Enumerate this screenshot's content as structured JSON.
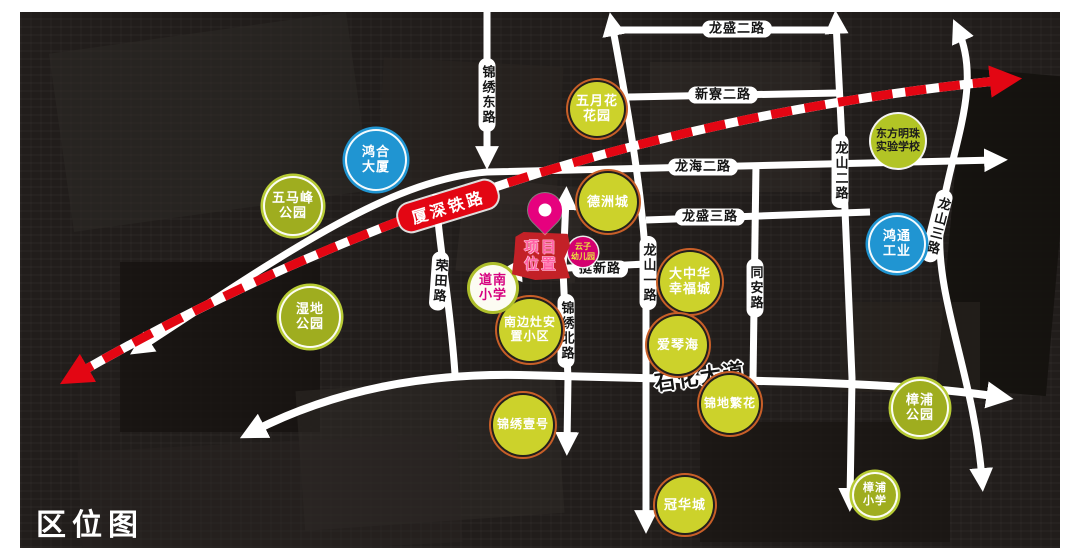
{
  "title": "区位图",
  "railway": {
    "label": "厦深铁路"
  },
  "project": {
    "line1": "项目",
    "line2": "位置"
  },
  "roads": [
    {
      "id": "jinxiu-east",
      "label": "锦绣东路"
    },
    {
      "id": "longsheng-2",
      "label": "龙盛二路"
    },
    {
      "id": "xinliao-2",
      "label": "新寮二路"
    },
    {
      "id": "longhai-2",
      "label": "龙海二路"
    },
    {
      "id": "longsheng-3",
      "label": "龙盛三路"
    },
    {
      "id": "longshan-1",
      "label": "龙山一路"
    },
    {
      "id": "longshan-2",
      "label": "龙山二路"
    },
    {
      "id": "longshan-3",
      "label": "龙山三路"
    },
    {
      "id": "tongan",
      "label": "同安路"
    },
    {
      "id": "rongtian",
      "label": "荣田路"
    },
    {
      "id": "tingxin",
      "label": "挺新路"
    },
    {
      "id": "jinxiu-north",
      "label": "锦绣北路"
    },
    {
      "id": "shihua",
      "label": "石化大道"
    }
  ],
  "landmarks": [
    {
      "id": "wumafeng-park",
      "type": "park",
      "line1": "五马峰",
      "line2": "公园"
    },
    {
      "id": "honghe-tower",
      "type": "blue",
      "line1": "鸿合",
      "line2": "大厦"
    },
    {
      "id": "wetland-park",
      "type": "park",
      "line1": "湿地",
      "line2": "公园"
    },
    {
      "id": "mayflower-garden",
      "type": "residential",
      "line1": "五月花",
      "line2": "花园"
    },
    {
      "id": "dezhoucheng",
      "type": "residential",
      "line1": "德洲城"
    },
    {
      "id": "dazhonghua-xingfucheng",
      "type": "residential",
      "line1": "大中华",
      "line2": "幸福城"
    },
    {
      "id": "aiqinhai",
      "type": "residential",
      "line1": "爱琴海"
    },
    {
      "id": "nanbianzao-estate",
      "type": "residential",
      "line1": "南边灶安",
      "line2": "置小区"
    },
    {
      "id": "jinxiu-yihao",
      "type": "residential",
      "line1": "锦绣壹号"
    },
    {
      "id": "jindi-fanhua",
      "type": "residential",
      "line1": "锦地繁花"
    },
    {
      "id": "guanhuacheng",
      "type": "residential",
      "line1": "冠华城"
    },
    {
      "id": "zhangpu-park",
      "type": "park",
      "line1": "樟浦",
      "line2": "公园"
    },
    {
      "id": "zhangpu-primary",
      "type": "park",
      "line1": "樟浦",
      "line2": "小学"
    },
    {
      "id": "dongfang-mingzhu-school",
      "type": "school",
      "line1": "东方明珠",
      "line2": "实验学校"
    },
    {
      "id": "hongtong-industry",
      "type": "blue",
      "line1": "鸿通",
      "line2": "工业"
    },
    {
      "id": "daonan-primary",
      "type": "daonan",
      "line1": "道南",
      "line2": "小学"
    },
    {
      "id": "yunzi-kindergarten",
      "type": "kindergarten",
      "line1": "云子",
      "line2": "幼儿园"
    }
  ],
  "colors": {
    "map_background": "#211d1b",
    "road_white": "#ffffff",
    "railway_red": "#e30613",
    "residential_fill": "#ccd22b",
    "residential_ring": "#c85f28",
    "park_fill": "#9fad1f",
    "park_ring": "#b7cb35",
    "landmark_blue": "#2095d2",
    "school_fill": "#b2c425",
    "project_magenta": "#e6017e",
    "project_red": "#c32127",
    "kindergarten_magenta": "#d4006f"
  }
}
